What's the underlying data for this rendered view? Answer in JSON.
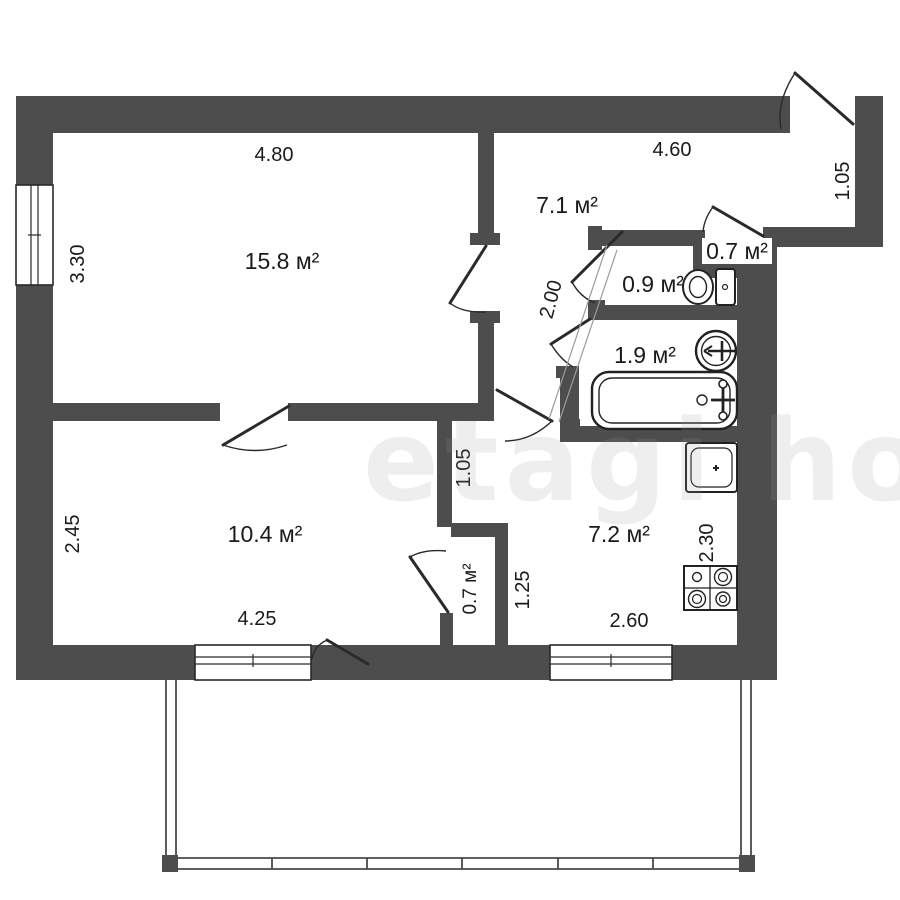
{
  "watermark": "etagi house",
  "plan": {
    "rooms": {
      "living": {
        "label": "15.8 м²"
      },
      "hall": {
        "label": "7.1 м²"
      },
      "closet_top": {
        "label": "0.7 м²"
      },
      "wc": {
        "label": "0.9 м²"
      },
      "bath": {
        "label": "1.9 м²"
      },
      "bedroom": {
        "label": "10.4 м²"
      },
      "closet_bottom": {
        "label": "0.7 м²"
      },
      "kitchen": {
        "label": "7.2 м²"
      }
    },
    "dims": {
      "living_w": "4.80",
      "living_h": "3.30",
      "hall_w": "4.60",
      "vestibule_w": "1.05",
      "hall_corr": "2.00",
      "bedroom_h": "2.45",
      "bedroom_w": "4.25",
      "corridor_w": "1.05",
      "closet_h": "1.25",
      "kitchen_h": "2.30",
      "kitchen_w": "2.60"
    },
    "fixtures": {
      "toilet": "toilet-icon",
      "sink_round": "round-sink-icon",
      "bathtub": "bathtub-icon",
      "kitchen_sink": "kitchen-sink-icon",
      "stove": "stove-4-burner-icon"
    },
    "colors": {
      "wall": "#4d4d4d",
      "line": "#2a2a2a",
      "dim_text": "#1a1a1a",
      "watermark": "#999999"
    }
  }
}
